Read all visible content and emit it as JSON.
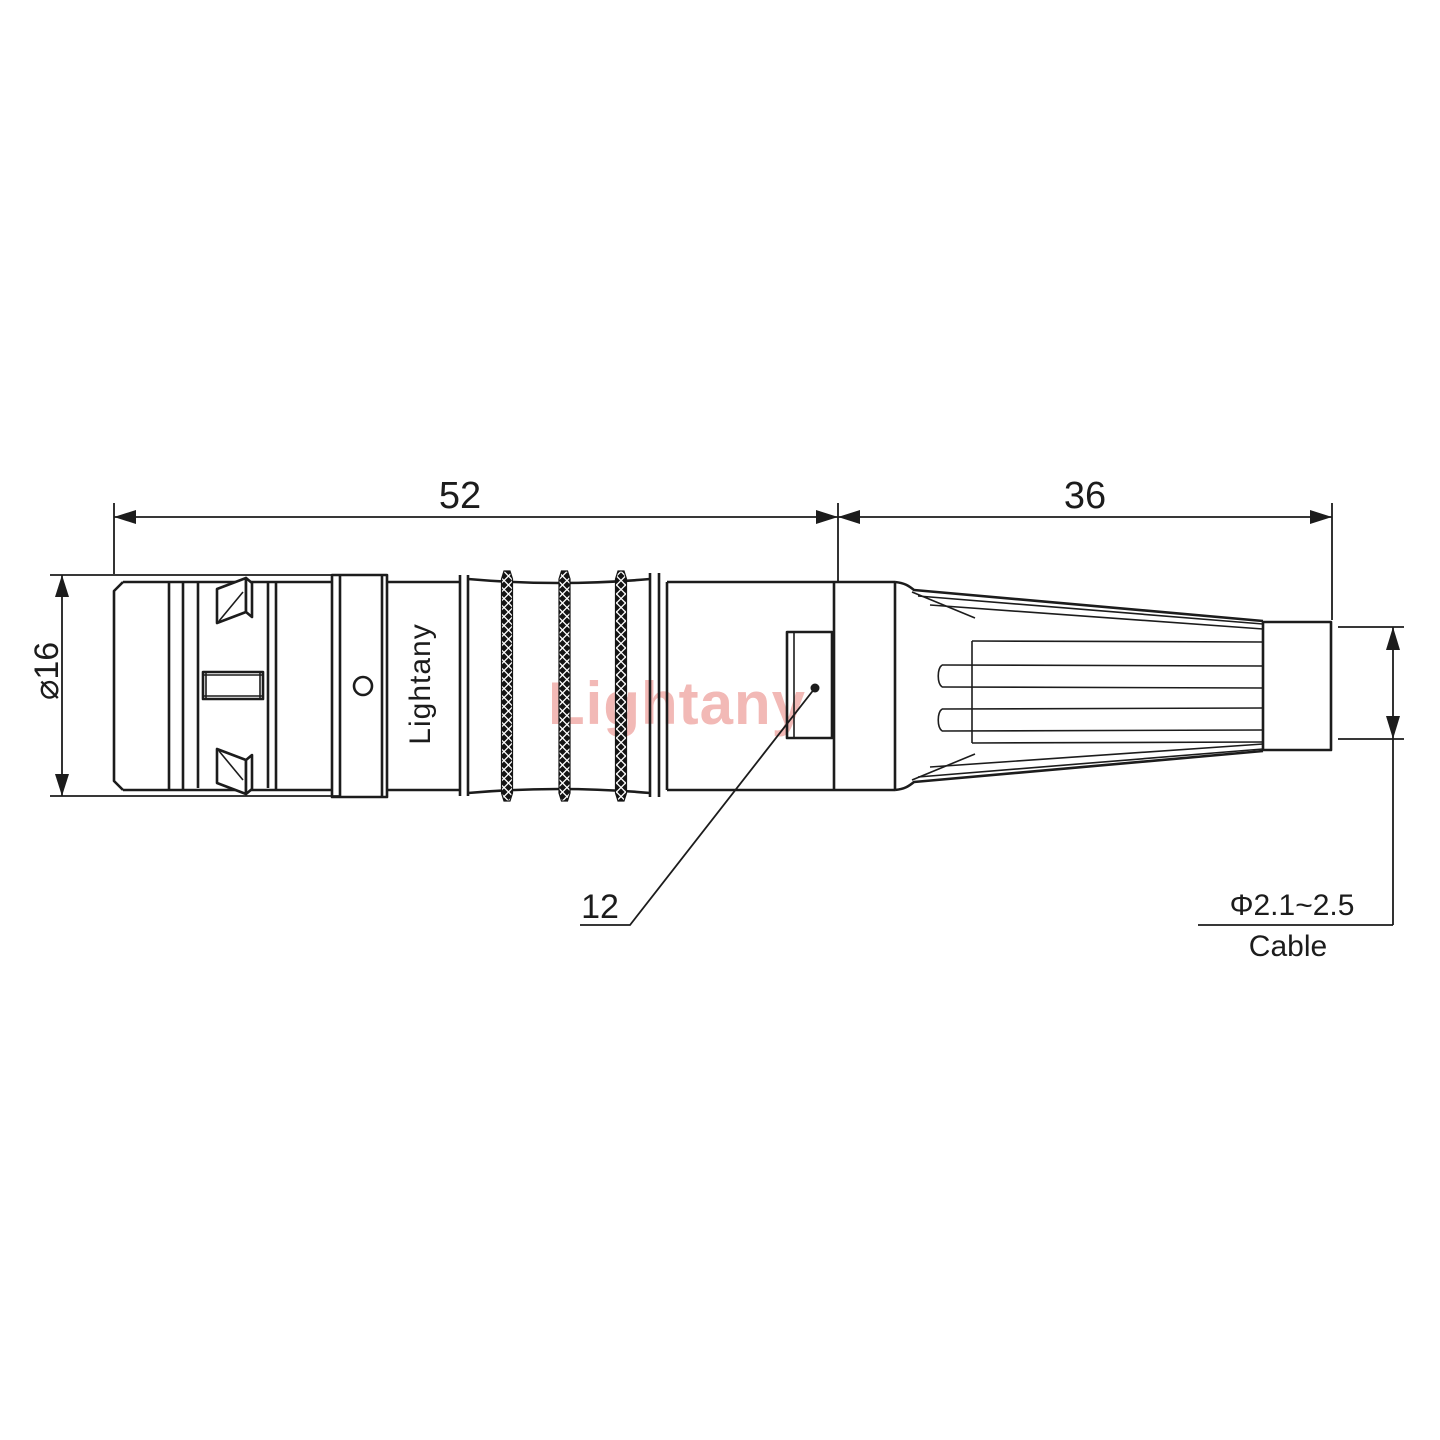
{
  "drawing": {
    "dimensions": {
      "main_length": "52",
      "boot_length": "36",
      "diameter": "⌀16",
      "ref_number": "12",
      "cable_diameter": "Φ2.1~2.5",
      "cable_label": "Cable"
    },
    "brand_engraving": "Lightany",
    "watermark": "Lightany",
    "colors": {
      "line": "#1c1c1c",
      "watermark": "#f2b9b6",
      "background": "#ffffff"
    }
  }
}
